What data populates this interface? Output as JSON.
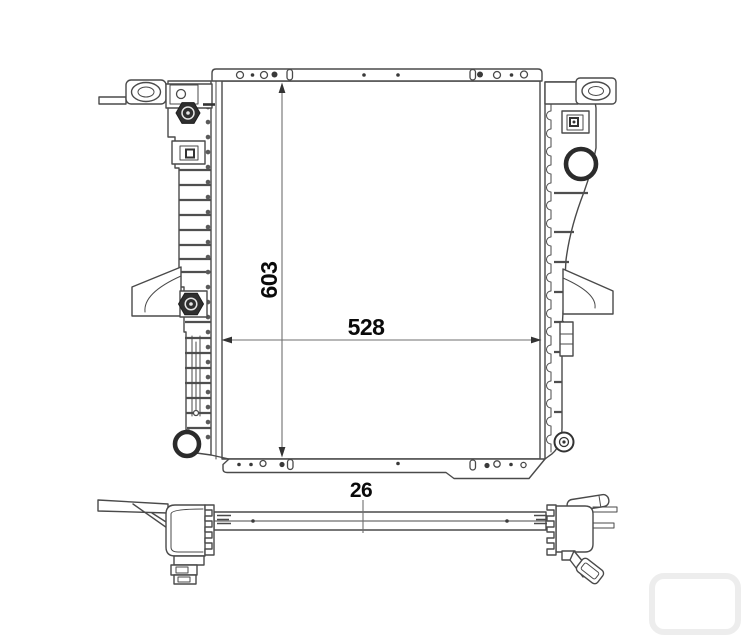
{
  "drawing": {
    "subject": "radiator-technical-drawing",
    "dimensions": {
      "height": {
        "value": "603"
      },
      "width": {
        "value": "528"
      },
      "depth": {
        "value": "26"
      }
    },
    "colors": {
      "background": "#ffffff",
      "outline": "#4a4a4a",
      "dark_fitting": "#2f2f2f",
      "dimension_line": "#6f6f6f",
      "label_text": "#0a0a0a"
    }
  }
}
